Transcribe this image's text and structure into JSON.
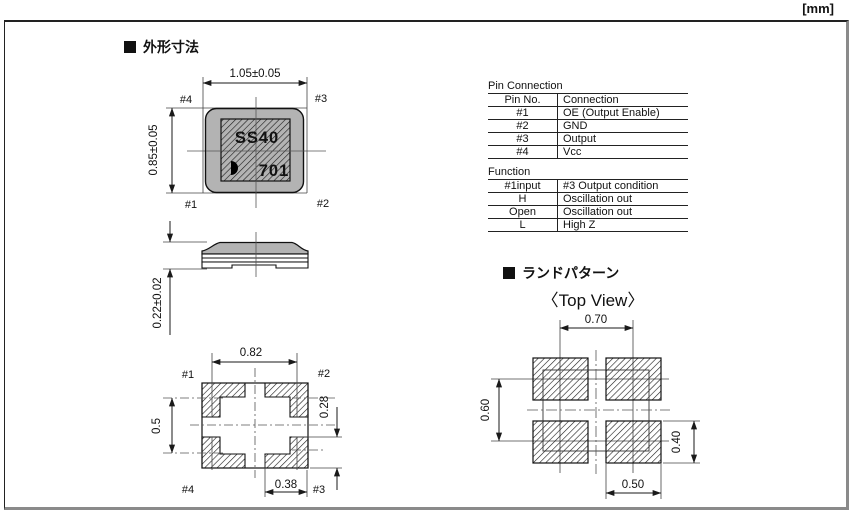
{
  "unit_label": "[mm]",
  "colors": {
    "body_gray": "#b3b3b3",
    "line_black": "#1a1a1a",
    "frame_shadow": "#8a8a8a"
  },
  "sections": {
    "outline_title": "外形寸法",
    "land_title": "ランドパターン",
    "land_view_label": "〈Top View〉"
  },
  "top_view": {
    "dim_width": "1.05±0.05",
    "dim_height": "0.85±0.05",
    "marking_line1": "SS40",
    "marking_line2": "701",
    "pin_top_left": "#4",
    "pin_top_right": "#3",
    "pin_bottom_left": "#1",
    "pin_bottom_right": "#2"
  },
  "side_view": {
    "dim_height": "0.22±0.02"
  },
  "bottom_view": {
    "dim_width": "0.82",
    "dim_pitch": "0.5",
    "dim_pad_height": "0.28",
    "dim_pad_width": "0.38",
    "pin_top_left": "#1",
    "pin_top_right": "#2",
    "pin_bottom_left": "#4",
    "pin_bottom_right": "#3"
  },
  "land_pattern": {
    "dim_pitch_x": "0.70",
    "dim_pitch_y": "0.60",
    "dim_pad_height": "0.40",
    "dim_pad_width": "0.50"
  },
  "pin_table": {
    "title": "Pin Connection",
    "headers": [
      "Pin No.",
      "Connection"
    ],
    "rows": [
      [
        "#1",
        "OE (Output Enable)"
      ],
      [
        "#2",
        "GND"
      ],
      [
        "#3",
        "Output"
      ],
      [
        "#4",
        "Vcc"
      ]
    ]
  },
  "function_table": {
    "title": "Function",
    "headers": [
      "#1input",
      "#3 Output condition"
    ],
    "rows": [
      [
        "H",
        "Oscillation out"
      ],
      [
        "Open",
        "Oscillation out"
      ],
      [
        "L",
        "High Z"
      ]
    ]
  }
}
